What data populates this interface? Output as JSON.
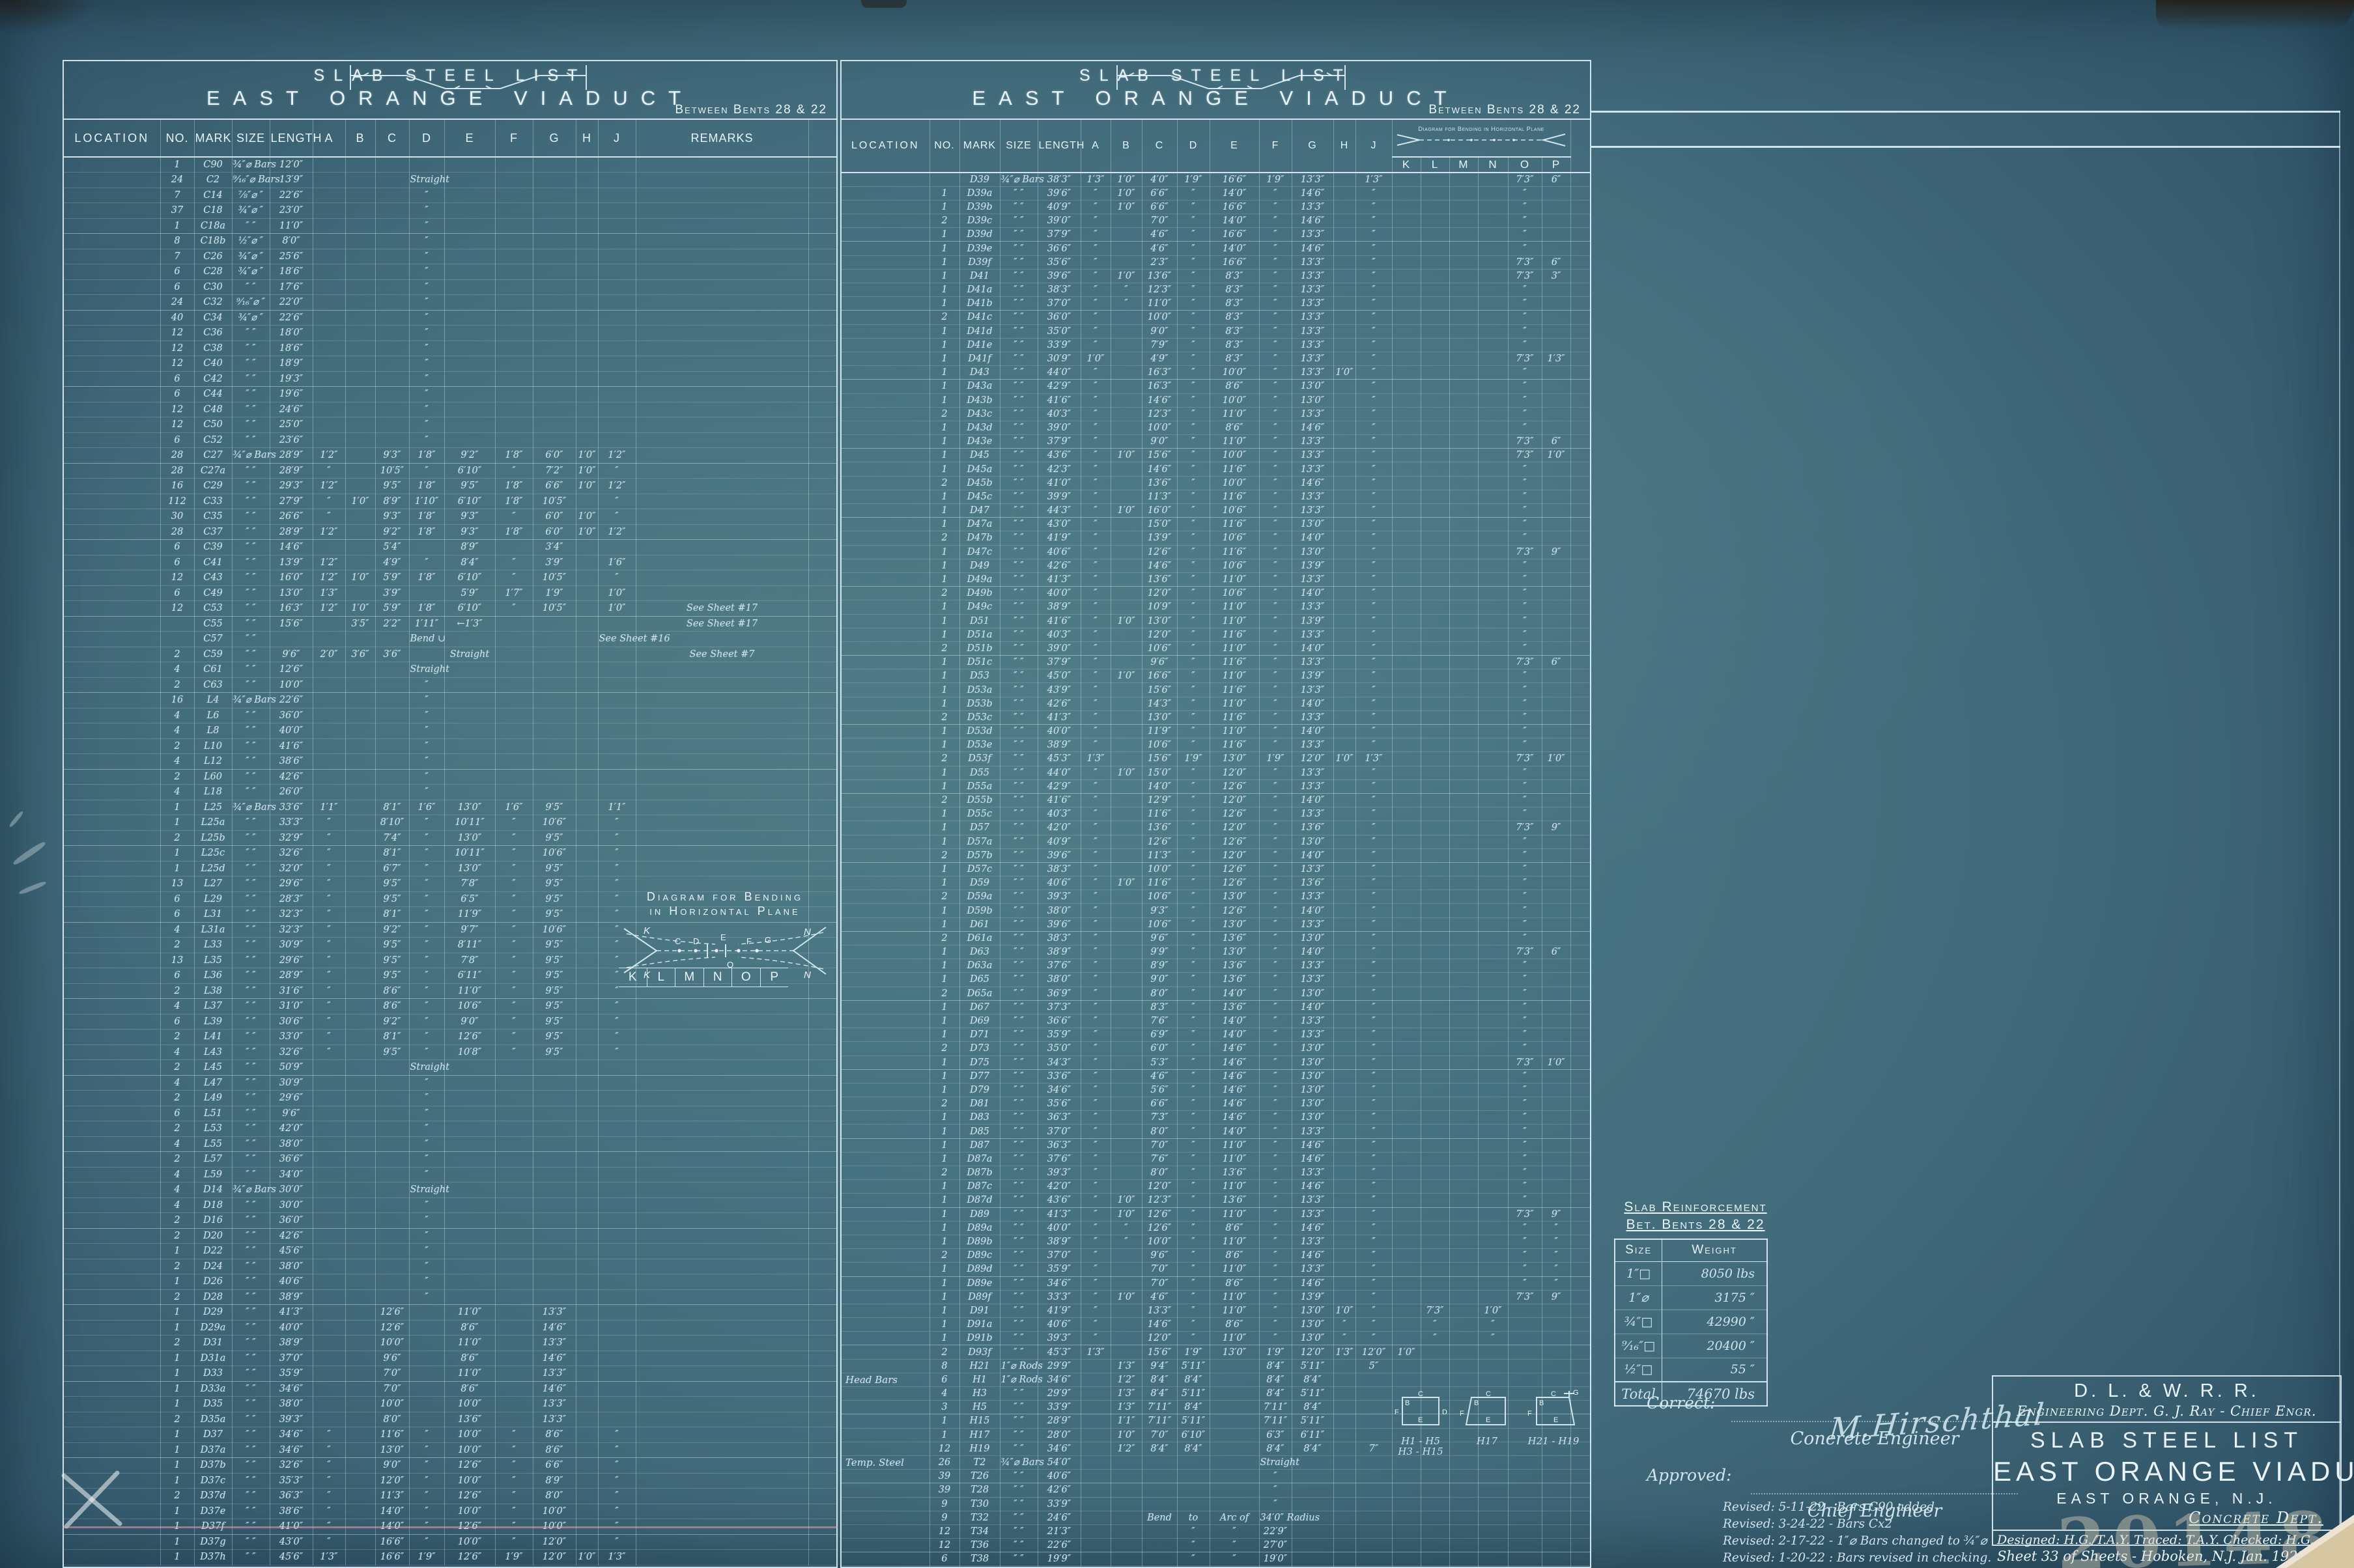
{
  "colors": {
    "sheet-center": "#4d7a87",
    "sheet-mid": "#426b7b",
    "sheet-edge": "#2c4f63",
    "ink": "#cfe4ec",
    "ink-bright": "#e9f5f8",
    "grid": "rgba(208,234,242,0.36)",
    "grid-strong": "rgba(228,246,251,0.88)",
    "pencil-pink": "rgba(240,168,178,0.5)",
    "stamp": "rgba(224,215,186,0.42)",
    "tear-tan": "#d6c6a2"
  },
  "letters": {
    "a": "A",
    "b": "B",
    "c": "C",
    "d": "D",
    "e": "E",
    "f": "F",
    "g": "G",
    "h": "H",
    "j": "J",
    "k": "K",
    "l": "L",
    "m": "M",
    "n": "N",
    "o": "O",
    "p": "P"
  },
  "left_panel": {
    "title1": "SLAB STEEL LIST",
    "title2": "EAST ORANGE VIADUCT",
    "subtitle": "Between Bents 28 & 22",
    "columns": [
      "LOCATION",
      "NO.",
      "MARK",
      "SIZE",
      "LENGTH",
      "A",
      "B",
      "C",
      "D",
      "E",
      "F",
      "G",
      "H",
      "J",
      "REMARKS"
    ],
    "hdiagram": {
      "line1": "Diagram for Bending",
      "line2": "in Horizontal Plane",
      "letters": [
        "K",
        "L",
        "M",
        "N",
        "O",
        "P"
      ]
    },
    "rows": [
      "|1|C90|¾″⌀ Bars|12′0″||||||||||",
      "|24|C2|⁹⁄₁₆″⌀ Bars|13′9″||||Straight||||||",
      "|7|C14|⅞″⌀ ″|22′6″||||″||||||",
      "|37|C18|¾″⌀ ″|23′0″||||″||||||",
      "|1|C18a|″ ″|11′0″||||″||||||",
      "|8|C18b|½″⌀ ″|8′0″||||″||||||",
      "|7|C26|¾″⌀ ″|25′6″||||″||||||",
      "|6|C28|¾″⌀ ″|18′6″||||″||||||",
      "|6|C30|″ ″|17′6″||||″||||||",
      "|24|C32|⁹⁄₁₆″⌀ ″|22′0″||||″||||||",
      "|40|C34|¾″⌀ ″|22′6″||||″||||||",
      "|12|C36|″ ″|18′0″||||″||||||",
      "|12|C38|″ ″|18′6″||||″||||||",
      "|12|C40|″ ″|18′9″||||″||||||",
      "|6|C42|″ ″|19′3″||||″||||||",
      "|6|C44|″ ″|19′6″||||″||||||",
      "|12|C48|″ ″|24′6″||||″||||||",
      "|12|C50|″ ″|25′0″||||″||||||",
      "|6|C52|″ ″|23′6″||||″||||||",
      "|28|C27|¾″⌀ Bars|28′9″|1′2″||9′3″|1′8″|9′2″|1′8″|6′0″|1′0″|1′2″|",
      "|28|C27a|″ ″|28′9″|″||10′5″|″|6′10″|″|7′2″|1′0″|″|",
      "|16|C29|″ ″|29′3″|1′2″||9′5″|1′8″|9′5″|1′8″|6′6″|1′0″|1′2″|",
      "|112|C33|″ ″|27′9″|″|1′0″|8′9″|1′10″|6′10″|1′8″|10′5″||″|",
      "|30|C35|″ ″|26′6″|″||9′3″|1′8″|9′3″|″|6′0″|1′0″|″|",
      "|28|C37|″ ″|28′9″|1′2″||9′2″|1′8″|9′3″|1′8″|6′0″|1′0″|1′2″|",
      "|6|C39|″ ″|14′6″|||5′4″||8′9″||3′4″|||",
      "|6|C41|″ ″|13′9″|1′2″||4′9″|″|8′4″|″|3′9″||1′6″|",
      "|12|C43|″ ″|16′0″|1′2″|1′0″|5′9″|1′8″|6′10″|″|10′5″||″|",
      "|6|C49|″ ″|13′0″|1′3″||3′9″||5′9″|1′7″|1′9″||1′0″|",
      "|12|C53|″ ″|16′3″|1′2″|1′0″|5′9″|1′8″|6′10″|″|10′5″||1′0″|See Sheet #17",
      "||C55|″ ″|15′6″||3′5″|2′2″|1′11″|←1′3″|||||See Sheet #17",
      "||C57|″ ″|||||Bend ∪|||||See Sheet #16",
      "|2|C59|″ ″|9′6″|2′0″|3′6″|3′6″||Straight|||||See Sheet #7",
      "|4|C61|″ ″|12′6″||||Straight||||||",
      "|2|C63|″ ″|10′0″||||″||||||",
      "|16|L4|¾″⌀ Bars|22′6″||||″||||||",
      "|4|L6|″ ″|36′0″||||″||||||",
      "|4|L8|″ ″|40′0″||||″||||||",
      "|2|L10|″ ″|41′6″||||″||||||",
      "|4|L12|″ ″|38′6″||||″||||||",
      "|2|L60|″ ″|42′6″||||″||||||",
      "|4|L18|″ ″|26′0″||||″||||||",
      "|1|L25|¾″⌀ Bars|33′6″|1′1″||8′1″|1′6″|13′0″|1′6″|9′5″||1′1″|",
      "|1|L25a|″ ″|33′3″|″||8′10″|″|10′11″|″|10′6″||″|",
      "|2|L25b|″ ″|32′9″|″||7′4″|″|13′0″|″|9′5″||″|",
      "|1|L25c|″ ″|32′6″|″||8′1″|″|10′11″|″|10′6″||″|",
      "|1|L25d|″ ″|32′0″|″||6′7″|″|13′0″|″|9′5″||″|",
      "|13|L27|″ ″|29′6″|″||9′5″|″|7′8″|″|9′5″||″|",
      "|6|L29|″ ″|28′3″|″||9′5″|″|6′5″|″|9′5″||″|",
      "|6|L31|″ ″|32′3″|″||8′1″|″|11′9″|″|9′5″||″|",
      "|4|L31a|″ ″|32′3″|″||9′2″|″|9′7″|″|10′6″||″|",
      "|2|L33|″ ″|30′9″|″||9′5″|″|8′11″|″|9′5″||″|",
      "|13|L35|″ ″|29′6″|″||9′5″|″|7′8″|″|9′5″||″|",
      "|6|L36|″ ″|28′9″|″||9′5″|″|6′11″|″|9′5″||″|",
      "|2|L38|″ ″|31′6″|″||8′6″|″|11′0″|″|9′5″||″|",
      "|4|L37|″ ″|31′0″|″||8′6″|″|10′6″|″|9′5″||″|",
      "|6|L39|″ ″|30′6″|″||9′2″|″|9′0″|″|9′5″||″|",
      "|2|L41|″ ″|33′0″|″||8′1″|″|12′6″|″|9′5″||″|",
      "|4|L43|″ ″|32′6″|″||9′5″|″|10′8″|″|9′5″||″|",
      "|2|L45|″ ″|50′9″||||Straight||||||",
      "|4|L47|″ ″|30′9″||||″||||||",
      "|2|L49|″ ″|29′6″||||″||||||",
      "|6|L51|″ ″|9′6″||||″||||||",
      "|2|L53|″ ″|42′0″||||″||||||",
      "|4|L55|″ ″|38′0″||||″||||||",
      "|2|L57|″ ″|36′6″||||″||||||",
      "|4|L59|″ ″|34′0″||||″||||||",
      "|4|D14|¾″⌀ Bars|30′0″||||Straight||||||",
      "|4|D18|″ ″|30′0″||||″||||||",
      "|2|D16|″ ″|36′0″||||″||||||",
      "|2|D20|″ ″|42′6″||||″||||||",
      "|1|D22|″ ″|45′6″||||″||||||",
      "|2|D24|″ ″|38′0″||||″||||||",
      "|1|D26|″ ″|40′6″||||″||||||",
      "|2|D28|″ ″|38′9″||||″||||||",
      "|1|D29|″ ″|41′3″|||12′6″||11′0″||13′3″|||",
      "|1|D29a|″ ″|40′0″|||12′6″||8′6″||14′6″|||",
      "|2|D31|″ ″|38′9″|||10′0″||11′0″||13′3″|||",
      "|1|D31a|″ ″|37′0″|||9′6″||8′6″||14′6″|||",
      "|1|D33|″ ″|35′9″|||7′0″||11′0″||13′3″|||",
      "|1|D33a|″ ″|34′6″|||7′0″||8′6″||14′6″|||",
      "|1|D35|″ ″|38′0″|||10′0″||10′0″||13′3″|||",
      "|2|D35a|″ ″|39′3″|||8′0″||13′6″||13′3″|||",
      "|1|D37|″ ″|34′6″|″||11′6″|″|10′0″|″|8′6″||″|",
      "|1|D37a|″ ″|34′6″|″||13′0″|″|10′0″|″|8′6″||″|",
      "|1|D37b|″ ″|32′6″|″||9′0″|″|12′6″|″|6′6″||″|",
      "|1|D37c|″ ″|35′3″|″||12′0″|″|10′0″|″|8′9″||″|",
      "|2|D37d|″ ″|36′3″|″||11′3″|″|12′6″|″|8′0″||″|",
      "|1|D37e|″ ″|38′6″|″||14′0″|″|10′0″|″|10′0″||″|",
      "|1|D37f|″ ″|41′0″|″||14′0″|″|12′6″|″|10′0″||″|",
      "|1|D37g|″ ″|43′0″|″||16′6″|″|10′0″|″|12′0″||″|",
      "|1|D37h|″ ″|45′6″|1′3″||16′6″|1′9″|12′6″|1′9″|12′0″|1′0″|1′3″|"
    ]
  },
  "middle_panel": {
    "title1": "SLAB STEEL LIST",
    "title2": "EAST ORANGE VIADUCT",
    "subtitle": "Between Bents 28 & 22",
    "columns": [
      "LOCATION",
      "NO.",
      "MARK",
      "SIZE",
      "LENGTH",
      "A",
      "B",
      "C",
      "D",
      "E",
      "F",
      "G",
      "H",
      "J"
    ],
    "diag_caption1": "Diagram for Bending in Horizontal Plane",
    "klmnop": [
      "K",
      "L",
      "M",
      "N",
      "O",
      "P"
    ],
    "bar_diagrams": [
      {
        "caption1": "H1 - H5",
        "caption2": "H3 - H15"
      },
      {
        "caption1": "H17",
        "caption2": ""
      },
      {
        "caption1": "H21 - H19",
        "caption2": ""
      }
    ],
    "rows": [
      "||D39|¾″⌀ Bars|38′3″|1′3″|1′0″|4′0″|1′9″|16′6″|1′9″|13′3″||1′3″|||||7′3″|6″",
      "|1|D39a|″ ″|39′6″|″|1′0″|6′6″|″|14′0″|″|14′6″||″|||||″|",
      "|1|D39b|″ ″|40′9″|″|1′0″|6′6″|″|16′6″|″|13′3″||″|||||″|",
      "|2|D39c|″ ″|39′0″|″||7′0″|″|14′0″|″|14′6″||″|||||″|",
      "|1|D39d|″ ″|37′9″|″||4′6″|″|16′6″|″|13′3″||″|||||″|",
      "|1|D39e|″ ″|36′6″|″||4′6″|″|14′0″|″|14′6″||″|||||″|",
      "|1|D39f|″ ″|35′6″|″||2′3″|″|16′6″|″|13′3″||″|||||7′3″|6″",
      "|1|D41|″ ″|39′6″|″|1′0″|13′6″|″|8′3″|″|13′3″||″|||||7′3″|3″",
      "|1|D41a|″ ″|38′3″|″|″|12′3″|″|8′3″|″|13′3″||″|||||″|",
      "|1|D41b|″ ″|37′0″|″|″|11′0″|″|8′3″|″|13′3″||″|||||″|",
      "|2|D41c|″ ″|36′0″|″||10′0″|″|8′3″|″|13′3″||″|||||″|",
      "|1|D41d|″ ″|35′0″|″||9′0″|″|8′3″|″|13′3″||″|||||″|",
      "|1|D41e|″ ″|33′9″|″||7′9″|″|8′3″|″|13′3″||″|||||″|",
      "|1|D41f|″ ″|30′9″|1′0″||4′9″|″|8′3″|″|13′3″||″|||||7′3″|1′3″",
      "|1|D43|″ ″|44′0″|″||16′3″|″|10′0″|″|13′3″|1′0″|″|||||″|",
      "|1|D43a|″ ″|42′9″|″||16′3″|″|8′6″|″|13′0″||″|||||″|",
      "|1|D43b|″ ″|41′6″|″||14′6″|″|10′0″|″|13′0″||″|||||″|",
      "|2|D43c|″ ″|40′3″|″||12′3″|″|11′0″|″|13′3″||″|||||″|",
      "|1|D43d|″ ″|39′0″|″||10′0″|″|8′6″|″|14′6″||″|||||″|",
      "|1|D43e|″ ″|37′9″|″||9′0″|″|11′0″|″|13′3″||″|||||7′3″|6″",
      "|1|D45|″ ″|43′6″|″|1′0″|15′6″|″|10′0″|″|13′3″||″|||||7′3″|1′0″",
      "|1|D45a|″ ″|42′3″|″||14′6″|″|11′6″|″|13′3″||″|||||″|",
      "|2|D45b|″ ″|41′0″|″||13′6″|″|10′0″|″|14′6″||″|||||″|",
      "|1|D45c|″ ″|39′9″|″||11′3″|″|11′6″|″|13′3″||″|||||″|",
      "|1|D47|″ ″|44′3″|″|1′0″|16′0″|″|10′6″|″|13′3″||″|||||″|",
      "|1|D47a|″ ″|43′0″|″||15′0″|″|11′6″|″|13′0″||″|||||″|",
      "|2|D47b|″ ″|41′9″|″||13′9″|″|10′6″|″|14′0″||″|||||″|",
      "|1|D47c|″ ″|40′6″|″||12′6″|″|11′6″|″|13′0″||″|||||7′3″|9″",
      "|1|D49|″ ″|42′6″|″||14′6″|″|10′6″|″|13′9″||″|||||″|",
      "|1|D49a|″ ″|41′3″|″||13′6″|″|11′0″|″|13′3″||″|||||″|",
      "|2|D49b|″ ″|40′0″|″||12′0″|″|10′6″|″|14′0″||″|||||″|",
      "|1|D49c|″ ″|38′9″|″||10′9″|″|11′0″|″|13′3″||″|||||″|",
      "|1|D51|″ ″|41′6″|″|1′0″|13′0″|″|11′0″|″|13′9″||″|||||″|",
      "|1|D51a|″ ″|40′3″|″||12′0″|″|11′6″|″|13′3″||″|||||″|",
      "|2|D51b|″ ″|39′0″|″||10′6″|″|11′0″|″|14′0″||″|||||″|",
      "|1|D51c|″ ″|37′9″|″||9′6″|″|11′6″|″|13′3″||″|||||7′3″|6″",
      "|1|D53|″ ″|45′0″|″|1′0″|16′6″|″|11′0″|″|13′9″||″|||||″|",
      "|1|D53a|″ ″|43′9″|″||15′6″|″|11′6″|″|13′3″||″|||||″|",
      "|1|D53b|″ ″|42′6″|″||14′3″|″|11′0″|″|14′0″||″|||||″|",
      "|2|D53c|″ ″|41′3″|″||13′0″|″|11′6″|″|13′3″||″|||||″|",
      "|1|D53d|″ ″|40′0″|″||11′9″|″|11′0″|″|14′0″||″|||||″|",
      "|1|D53e|″ ″|38′9″|″||10′6″|″|11′6″|″|13′3″||″|||||″|",
      "|2|D53f|″ ″|45′3″|1′3″||15′6″|1′9″|13′0″|1′9″|12′0″|1′0″|1′3″|||||7′3″|1′0″",
      "|1|D55|″ ″|44′0″|″|1′0″|15′0″|″|12′0″|″|13′3″||″|||||″|",
      "|1|D55a|″ ″|42′9″|″||14′0″|″|12′6″|″|13′3″||″|||||″|",
      "|2|D55b|″ ″|41′6″|″||12′9″|″|12′0″|″|14′0″||″|||||″|",
      "|1|D55c|″ ″|40′3″|″||11′6″|″|12′6″|″|13′3″||″|||||″|",
      "|1|D57|″ ″|42′0″|″||13′6″|″|12′0″|″|13′6″||″|||||7′3″|9″",
      "|1|D57a|″ ″|40′9″|″||12′6″|″|12′6″|″|13′0″||″|||||″|",
      "|2|D57b|″ ″|39′6″|″||11′3″|″|12′0″|″|14′0″||″|||||″|",
      "|1|D57c|″ ″|38′3″|″||10′0″|″|12′6″|″|13′3″||″|||||″|",
      "|1|D59|″ ″|40′6″|″|1′0″|11′6″|″|12′6″|″|13′6″||″|||||″|",
      "|2|D59a|″ ″|39′3″|″||10′6″|″|13′0″|″|13′3″||″|||||″|",
      "|1|D59b|″ ″|38′0″|″||9′3″|″|12′6″|″|14′0″||″|||||″|",
      "|1|D61|″ ″|39′6″|″||10′6″|″|13′0″|″|13′3″||″|||||″|",
      "|2|D61a|″ ″|38′3″|″||9′6″|″|13′6″|″|13′0″||″|||||″|",
      "|1|D63|″ ″|38′9″|″||9′9″|″|13′0″|″|14′0″||″|||||7′3″|6″",
      "|1|D63a|″ ″|37′6″|″||8′9″|″|13′6″|″|13′3″||″|||||″|",
      "|1|D65|″ ″|38′0″|″||9′0″|″|13′6″|″|13′3″||″|||||″|",
      "|2|D65a|″ ″|36′9″|″||8′0″|″|14′0″|″|13′0″||″|||||″|",
      "|1|D67|″ ″|37′3″|″||8′3″|″|13′6″|″|14′0″||″|||||″|",
      "|1|D69|″ ″|36′6″|″||7′6″|″|14′0″|″|13′3″||″|||||″|",
      "|1|D71|″ ″|35′9″|″||6′9″|″|14′0″|″|13′3″||″|||||″|",
      "|2|D73|″ ″|35′0″|″||6′0″|″|14′6″|″|13′0″||″|||||″|",
      "|1|D75|″ ″|34′3″|″||5′3″|″|14′6″|″|13′0″||″|||||7′3″|1′0″",
      "|1|D77|″ ″|33′6″|″||4′6″|″|14′6″|″|13′0″||″|||||″|",
      "|1|D79|″ ″|34′6″|″||5′6″|″|14′6″|″|13′0″||″|||||″|",
      "|2|D81|″ ″|35′6″|″||6′6″|″|14′6″|″|13′0″||″|||||″|",
      "|1|D83|″ ″|36′3″|″||7′3″|″|14′6″|″|13′0″||″|||||″|",
      "|1|D85|″ ″|37′0″|″||8′0″|″|14′0″|″|13′3″||″|||||″|",
      "|1|D87|″ ″|36′3″|″||7′0″|″|11′0″|″|14′6″||″|||||″|",
      "|1|D87a|″ ″|37′6″|″||7′6″|″|11′0″|″|14′6″||″|||||″|",
      "|2|D87b|″ ″|39′3″|″||8′0″|″|13′6″|″|13′3″||″|||||″|",
      "|1|D87c|″ ″|42′0″|″||12′0″|″|11′0″|″|14′6″||″|||||″|",
      "|1|D87d|″ ″|43′6″|″|1′0″|12′3″|″|13′6″|″|13′3″||″|||||″|",
      "|1|D89|″ ″|41′3″|″|1′0″|12′6″|″|11′0″|″|13′3″||″|||||7′3″|9″",
      "|1|D89a|″ ″|40′0″|″|″|12′6″|″|8′6″|″|14′6″||″|||||″|″",
      "|1|D89b|″ ″|38′9″|″|″|10′0″|″|11′0″|″|13′3″||″|||||″|″",
      "|2|D89c|″ ″|37′0″|″||9′6″|″|8′6″|″|14′6″||″|||||″|″",
      "|1|D89d|″ ″|35′9″|″||7′0″|″|11′0″|″|13′3″||″|||||″|″",
      "|1|D89e|″ ″|34′6″|″||7′0″|″|8′6″|″|14′6″||″|||||″|″",
      "|1|D89f|″ ″|33′3″|″|1′0″|4′6″|″|11′0″|″|13′9″||″|||||7′3″|9″",
      "|1|D91|″ ″|41′9″|″||13′3″|″|11′0″|″|13′0″|1′0″|″||7′3″||1′0″||",
      "|1|D91a|″ ″|40′6″|″||14′6″|″|8′6″|″|13′0″|″|″||″||″||",
      "|1|D91b|″ ″|39′3″|″||12′0″|″|11′0″|″|13′0″|″|″||″||″||",
      "|2|D93f|″ ″|45′3″|1′3″||15′6″|1′9″|13′0″|1′9″|12′0″|1′3″|12′0″|1′0″|||||",
      "|8|H21|1″⌀ Rods|29′9″||1′3″|9′4″|5′11″||8′4″|5′11″||5″||||||",
      "Head Bars|6|H1|1″⌀ Rods|34′6″||1′2″|8′4″|8′4″||8′4″|8′4″||||||||",
      "|4|H3|″ ″|29′9″||1′3″|8′4″|5′11″||8′4″|5′11″||||||||",
      "|3|H5|″ ″|33′9″||1′3″|7′11″|8′4″||7′11″|8′4″||||||||",
      "|1|H15|″ ″|28′9″||1′1″|7′11″|5′11″||7′11″|5′11″||||||||",
      "|1|H17|″ ″|28′0″||1′0″|7′0″|6′10″||6′3″|6′11″||||||||",
      "|12|H19|″ ″|34′6″||1′2″|8′4″|8′4″||8′4″|8′4″||7″|||||||",
      "Temp. Steel|26|T2|¾″⌀ Bars|54′0″||||||Straight|||||||||",
      "|39|T26|″ ″|40′6″||||||″|||||||||",
      "|39|T28|″ ″|42′6″||||||″|||||||||",
      "|9|T30|″ ″|33′9″||||||″|||||||||",
      "|9|T32|″ ″|24′6″|||Bend|to|Arc of|34′0″ Radius|||||||||",
      "|12|T34|″ ″|21′3″||||″|″|22′9″|||||||||",
      "|12|T36|″ ″|22′6″||||″|″|27′0″|||||||||",
      "|6|T38|″ ″|19′9″||||″|″|19′0″|||||||||",
      "|3|T40|″ ″|28′0″|||||Straight||||||||||"
    ]
  },
  "right_panel": {
    "reinforcement": {
      "title1": "Slab Reinforcement",
      "title2": "Bet. Bents 28 & 22",
      "col_size": "Size",
      "col_weight": "Weight",
      "rows": [
        "1″□|8050 lbs",
        "1″⌀|3175 ″",
        "¾″□|42990 ″",
        "⁹⁄₁₆″□|20400 ″",
        "½″□|55 ″"
      ],
      "total_label": "Total",
      "total_value": "74670 lbs"
    },
    "signatures": {
      "correct_label": "Correct:",
      "signature": "M.Hirschthal",
      "correct_title": "Concrete Engineer",
      "approved_label": "Approved:",
      "approved_title": "Chief Engineer"
    },
    "revisions": [
      "Revised: 5-11-22 - Bars C90 added",
      "Revised: 3-24-22 - Bars Cx2",
      "Revised: 2-17-22 - 1″⌀ Bars changed to ¾″⌀",
      "Revised: 1-20-22 : Bars revised in checking."
    ],
    "title_block": {
      "company": "D. L. & W. R. R.",
      "dept": "Engineering Dept.   G. J. Ray - Chief Engr.",
      "doc_title": "SLAB STEEL LIST",
      "project": "EAST ORANGE VIADUCT",
      "location": "EAST ORANGE, N.J.",
      "dept2": "Concrete Dept.",
      "credits": "Designed: H.G./T.A.Y.    Traced: T.A.Y.    Checked: H.G.",
      "sheet_line": "Sheet 33 of        Sheets - Hoboken, N.J.  Jan.  1922"
    },
    "stamp": "20148"
  }
}
